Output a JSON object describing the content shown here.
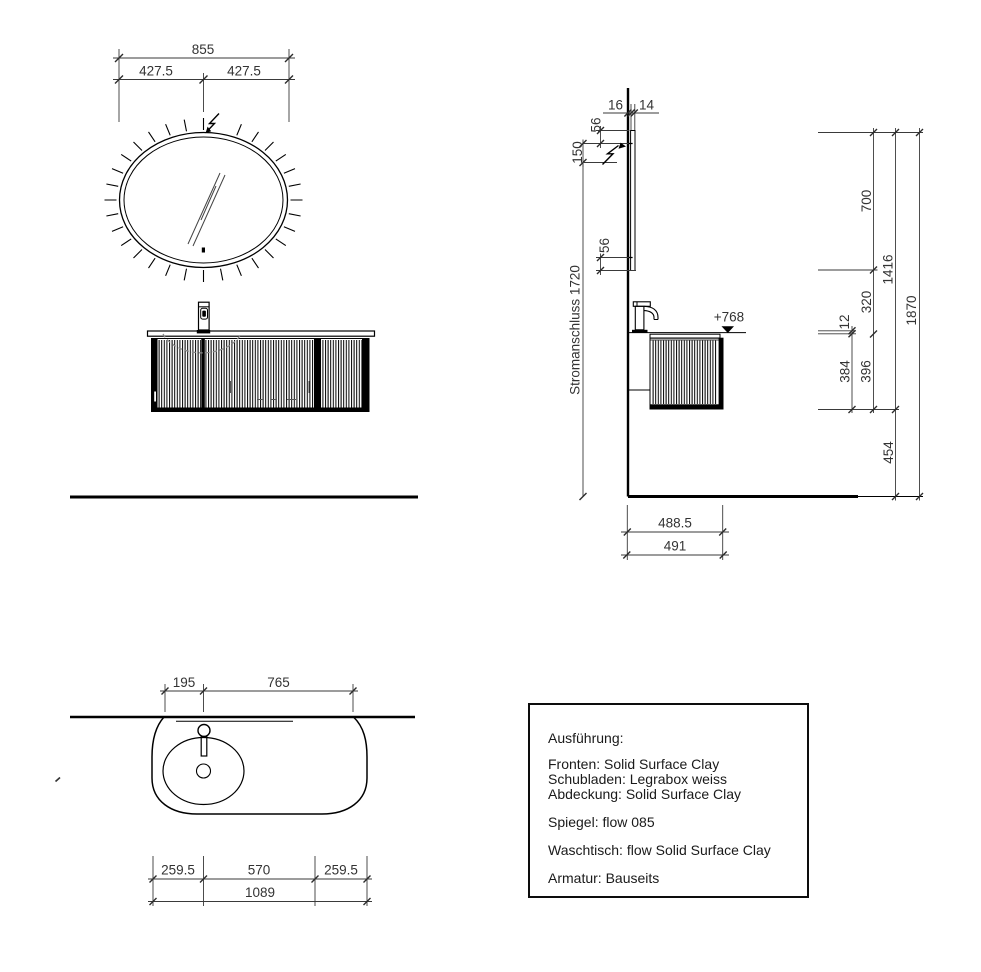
{
  "drawing": {
    "front_view": {
      "width_total": "855",
      "width_left": "427.5",
      "width_right": "427.5"
    },
    "side_view": {
      "offset_wall": "16",
      "mirror_thickness": "14",
      "led_top_offset": "56",
      "electrical_offset": "150",
      "led_bottom_offset": "56",
      "electrical_label": "Stromanschluss 1720",
      "counter_height_level": "+768",
      "mirror_height": "700",
      "mirror_bottom_to_counter": "320",
      "counter_thickness": "12",
      "cabinet_height": "384",
      "counter_to_cabinet_bottom": "396",
      "height_mirror_top_to_cabinet": "1416",
      "height_total": "1870",
      "cabinet_bottom_clearance": "454",
      "depth_counter": "488.5",
      "depth_total": "491"
    },
    "plan_view": {
      "basin_left_offset": "195",
      "basin_center_to_right": "765",
      "overhang_left": "259.5",
      "basin_span": "570",
      "overhang_right": "259.5",
      "width_total": "1089"
    }
  },
  "spec_box": {
    "title": "Ausführung:",
    "materials": [
      "Fronten: Solid Surface Clay",
      "Schubladen: Legrabox weiss",
      "Abdeckung: Solid Surface Clay"
    ],
    "mirror": "Spiegel: flow 085",
    "washbasin": "Waschtisch: flow Solid Surface Clay",
    "fittings": "Armatur: Bauseits"
  },
  "colors": {
    "line": "#000000",
    "dim_text": "#333333",
    "background": "#ffffff"
  }
}
